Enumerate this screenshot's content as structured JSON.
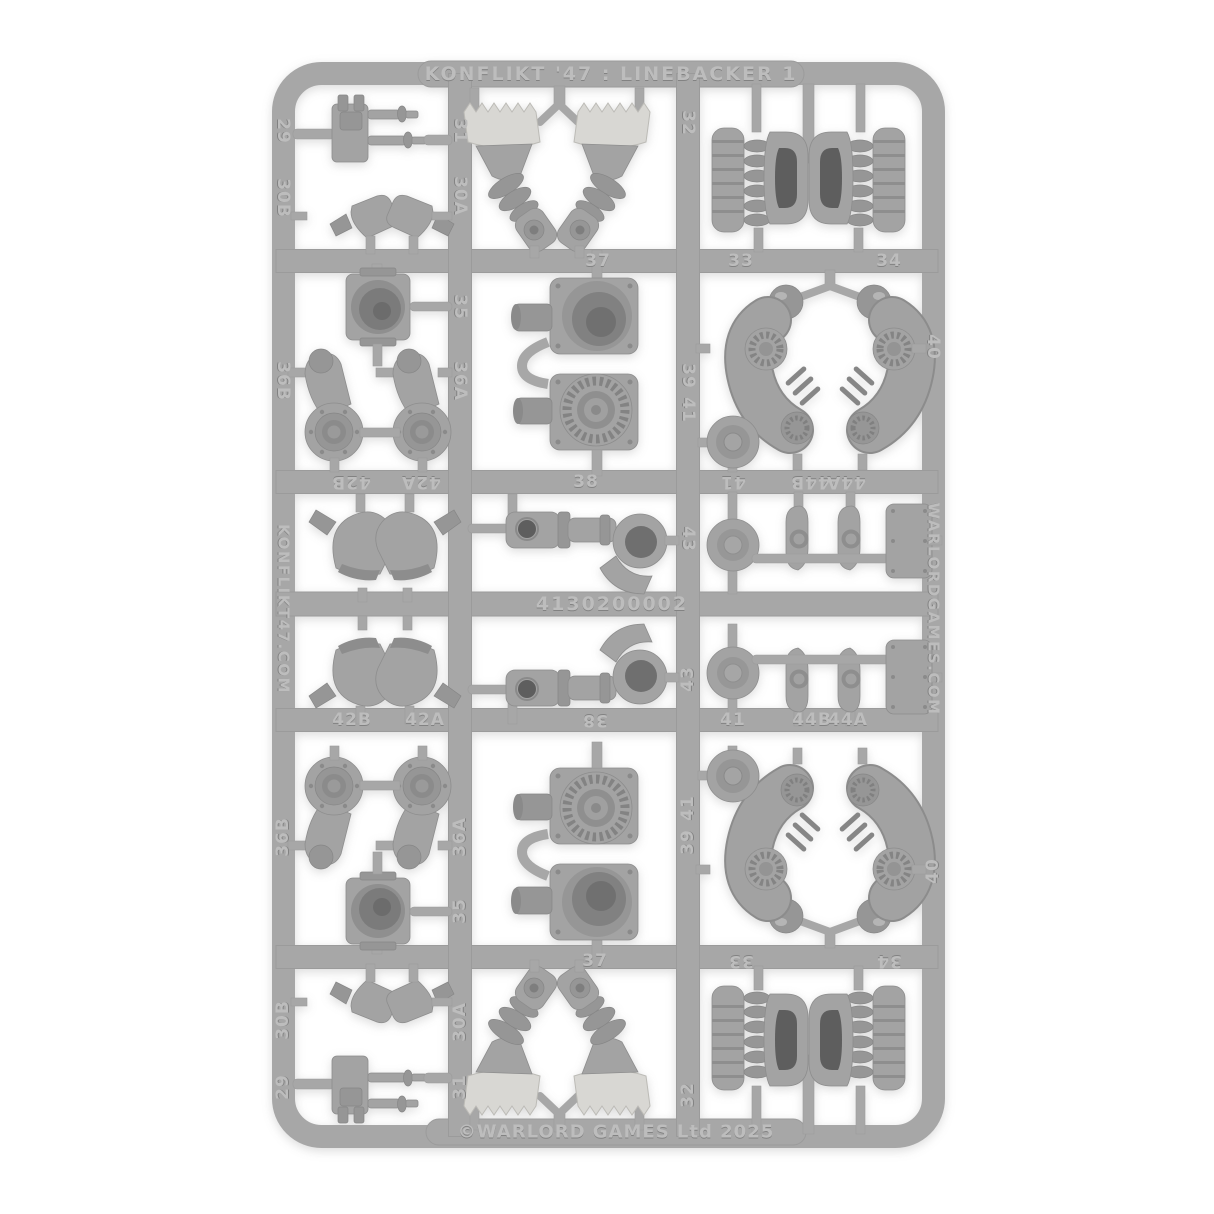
{
  "image": {
    "kind": "product photo of a plastic model kit sprue on white background",
    "width": 1214,
    "height": 1214,
    "background_color": "#ffffff",
    "sprue_color": "#a7a7a7",
    "part_color": "#a3a3a3",
    "foot_pad_color": "#d8d7d3",
    "emboss_text_color": "#bdbdbd"
  },
  "sprue": {
    "title": "KONFLIKT '47 : LINEBACKER 1",
    "product_code": "4130200002",
    "left_rail_text": "KONFLIKT47.COM",
    "right_rail_text": "WARLORDGAMES.COM",
    "copyright": "©WARLORD GAMES Ltd 2025",
    "part_numbers": [
      "29",
      "30A",
      "30B",
      "31",
      "32",
      "33",
      "34",
      "35",
      "36A",
      "36B",
      "37",
      "38",
      "39",
      "40",
      "41",
      "42A",
      "42B",
      "43",
      "44A",
      "44B"
    ],
    "labels": [
      {
        "t": "29",
        "x": 283,
        "y": 131,
        "r": 90
      },
      {
        "t": "30B",
        "x": 283,
        "y": 198,
        "r": 90
      },
      {
        "t": "31",
        "x": 460,
        "y": 131,
        "r": 90
      },
      {
        "t": "30A",
        "x": 460,
        "y": 196,
        "r": 90
      },
      {
        "t": "32",
        "x": 688,
        "y": 123,
        "r": 90
      },
      {
        "t": "33",
        "x": 741,
        "y": 261,
        "r": 0
      },
      {
        "t": "34",
        "x": 889,
        "y": 261,
        "r": 0
      },
      {
        "t": "37",
        "x": 598,
        "y": 261,
        "r": 0
      },
      {
        "t": "35",
        "x": 460,
        "y": 307,
        "r": 90
      },
      {
        "t": "36B",
        "x": 283,
        "y": 381,
        "r": 90
      },
      {
        "t": "36A",
        "x": 460,
        "y": 381,
        "r": 90
      },
      {
        "t": "39",
        "x": 688,
        "y": 376,
        "r": 90
      },
      {
        "t": "41",
        "x": 688,
        "y": 410,
        "r": 90
      },
      {
        "t": "40",
        "x": 933,
        "y": 347,
        "r": 90
      },
      {
        "t": "42B",
        "x": 351,
        "y": 482,
        "r": 180
      },
      {
        "t": "42A",
        "x": 421,
        "y": 482,
        "r": 180
      },
      {
        "t": "41",
        "x": 733,
        "y": 482,
        "r": 180
      },
      {
        "t": "44B",
        "x": 810,
        "y": 482,
        "r": 180
      },
      {
        "t": "44A",
        "x": 846,
        "y": 482,
        "r": 180
      },
      {
        "t": "38",
        "x": 586,
        "y": 482,
        "r": 0
      },
      {
        "t": "43",
        "x": 688,
        "y": 539,
        "r": 90
      },
      {
        "t": "42B",
        "x": 352,
        "y": 720,
        "r": 0
      },
      {
        "t": "42A",
        "x": 425,
        "y": 720,
        "r": 0
      },
      {
        "t": "41",
        "x": 733,
        "y": 720,
        "r": 0
      },
      {
        "t": "44B",
        "x": 812,
        "y": 720,
        "r": 0
      },
      {
        "t": "44A",
        "x": 848,
        "y": 720,
        "r": 0
      },
      {
        "t": "38",
        "x": 595,
        "y": 720,
        "r": 180
      },
      {
        "t": "43",
        "x": 688,
        "y": 679,
        "r": 270
      },
      {
        "t": "36B",
        "x": 283,
        "y": 837,
        "r": 270
      },
      {
        "t": "36A",
        "x": 460,
        "y": 837,
        "r": 270
      },
      {
        "t": "35",
        "x": 460,
        "y": 911,
        "r": 270
      },
      {
        "t": "41",
        "x": 688,
        "y": 808,
        "r": 270
      },
      {
        "t": "39",
        "x": 688,
        "y": 842,
        "r": 270
      },
      {
        "t": "40",
        "x": 933,
        "y": 871,
        "r": 270
      },
      {
        "t": "37",
        "x": 595,
        "y": 961,
        "r": 0
      },
      {
        "t": "33",
        "x": 741,
        "y": 961,
        "r": 180
      },
      {
        "t": "34",
        "x": 889,
        "y": 961,
        "r": 180
      },
      {
        "t": "30B",
        "x": 283,
        "y": 1020,
        "r": 270
      },
      {
        "t": "30A",
        "x": 460,
        "y": 1022,
        "r": 270
      },
      {
        "t": "29",
        "x": 283,
        "y": 1087,
        "r": 270
      },
      {
        "t": "31",
        "x": 460,
        "y": 1087,
        "r": 270
      },
      {
        "t": "32",
        "x": 688,
        "y": 1095,
        "r": 270
      }
    ]
  }
}
